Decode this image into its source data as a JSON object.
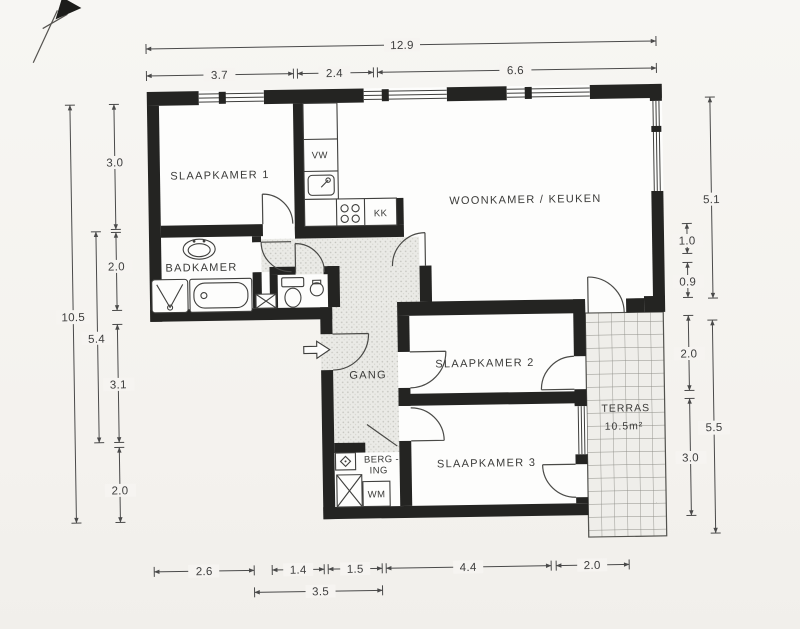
{
  "rooms": {
    "slaapkamer1": "SLAAPKAMER 1",
    "slaapkamer2": "SLAAPKAMER 2",
    "slaapkamer3": "SLAAPKAMER 3",
    "badkamer": "BADKAMER",
    "woonkamer_keuken": "WOONKAMER / KEUKEN",
    "gang": "GANG",
    "berging_line1": "BERG -",
    "berging_line2": "ING",
    "terras": "TERRAS",
    "terras_area": "10.5m²"
  },
  "appliances": {
    "dishwasher": "VW",
    "fridge": "KK",
    "washer": "WM"
  },
  "dimensions": {
    "top": {
      "total": "12.9",
      "a": "3.7",
      "b": "2.4",
      "c": "6.6"
    },
    "left": {
      "total": "10.5",
      "mid": "5.4",
      "a": "3.0",
      "b": "2.0",
      "c": "3.1",
      "d": "2.0"
    },
    "right": {
      "a": "5.1",
      "b": "1.0",
      "c": "0.9",
      "d": "2.0",
      "e": "3.0",
      "total": "5.5"
    },
    "bottom": {
      "a": "2.6",
      "b": "1.4",
      "c": "1.5",
      "d": "4.4",
      "e": "2.0",
      "mid": "3.5"
    }
  }
}
